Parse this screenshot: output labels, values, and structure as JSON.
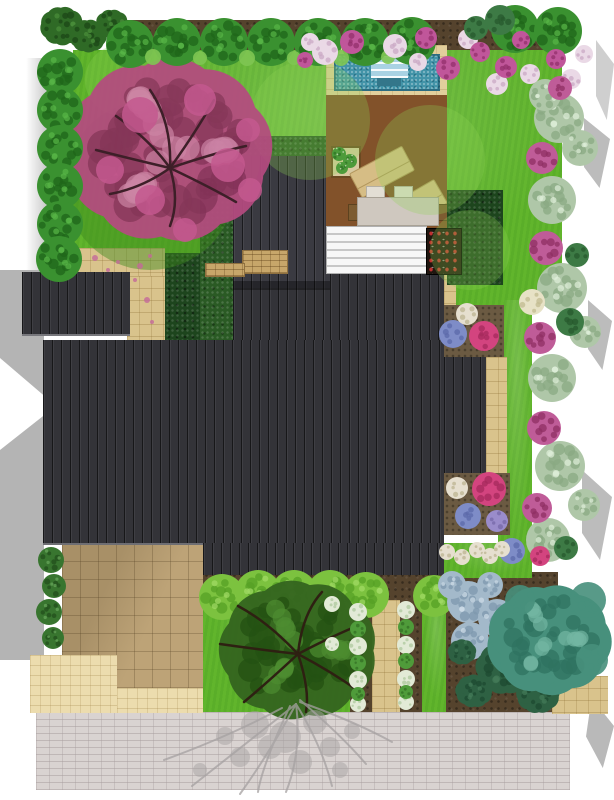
{
  "scene_type": "landscape-garden-design-plan-top-view",
  "palette": {
    "lawn": "#61b52c",
    "roof": "#333338",
    "deck_wood": "#82522a",
    "pool_water": "#4293a8",
    "pool_steps": "#a9d2e3",
    "hedge_dark": "#1d451d",
    "patio_tan": "#bda377",
    "path_beige": "#d9c38c",
    "driveway_gray": "#d9d3d1",
    "soil": "#55432d",
    "pink_tree": "#b54b80",
    "border_pink": "#bf5c98",
    "border_silver": "#afc7a8",
    "teal_tree": "#47907c",
    "shadow_gray": "#bcbcbc"
  },
  "plants": {
    "groups": [
      {
        "name": "lawn-shade-under-tree",
        "type": "blob",
        "fill": "#3f8b1e",
        "op": 0.45,
        "items": [
          [
            150,
            185,
            85
          ],
          [
            210,
            160,
            50
          ]
        ]
      },
      {
        "name": "lawn-light-patches",
        "type": "blob",
        "fill": "#8fd455",
        "op": 0.28,
        "items": [
          [
            310,
            120,
            60
          ],
          [
            430,
            160,
            55
          ],
          [
            120,
            80,
            35
          ],
          [
            470,
            250,
            40
          ]
        ]
      },
      {
        "name": "pink-flowering-tree-canopy",
        "type": "canopy",
        "fill": "#b54b80",
        "spot": "#8a2f5c",
        "hi": "#d683ae",
        "op": 0.93,
        "items": [
          [
            168,
            150,
            95
          ]
        ]
      },
      {
        "name": "pink-tree-branches",
        "type": "branches",
        "stroke": "#3d1f28",
        "width": 2.5,
        "paths": [
          "M170 168 Q150 140 116 116",
          "M170 168 Q172 122 150 90",
          "M170 168 Q196 132 214 100",
          "M170 168 Q218 152 246 146",
          "M170 168 Q212 188 236 202",
          "M170 168 Q142 188 110 194",
          "M170 168 Q136 160 96 150",
          "M170 168 Q180 200 170 226"
        ]
      },
      {
        "name": "pink-tree-outer-blossoms",
        "type": "blob",
        "fill": "#c4598f",
        "op": 0.85,
        "items": [
          [
            140,
            115,
            18
          ],
          [
            200,
            100,
            16
          ],
          [
            228,
            165,
            17
          ],
          [
            150,
            200,
            15
          ],
          [
            110,
            170,
            14
          ],
          [
            250,
            190,
            12
          ],
          [
            185,
            230,
            12
          ],
          [
            248,
            130,
            12
          ]
        ]
      },
      {
        "name": "top-corner-bamboo",
        "type": "canopy",
        "fill": "#2f6a26",
        "spot": "#1c4717",
        "hi": "#4a8f3a",
        "items": [
          [
            62,
            26,
            20
          ],
          [
            88,
            36,
            17
          ],
          [
            112,
            24,
            15
          ],
          [
            135,
            40,
            14
          ]
        ]
      },
      {
        "name": "top-border-shrubs",
        "type": "shrub",
        "r": 24,
        "fill": "#3a9130",
        "spot": "#1f661a",
        "hi": "#58b647",
        "items": [
          [
            130,
            44
          ],
          [
            177,
            42
          ],
          [
            224,
            42
          ],
          [
            271,
            42
          ],
          [
            318,
            42
          ],
          [
            365,
            42
          ],
          [
            412,
            41
          ],
          [
            515,
            29
          ],
          [
            558,
            31
          ]
        ]
      },
      {
        "name": "left-border-shrubs",
        "type": "shrub",
        "r": 23,
        "fill": "#3a9130",
        "spot": "#1f661a",
        "hi": "#58b647",
        "items": [
          [
            60,
            72
          ],
          [
            60,
            110
          ],
          [
            60,
            148
          ],
          [
            60,
            186
          ],
          [
            60,
            224
          ],
          [
            59,
            259
          ]
        ]
      },
      {
        "name": "top-border-tufts",
        "type": "blob",
        "fill": "#7fc653",
        "op": 0.9,
        "items": [
          [
            153,
            57,
            8
          ],
          [
            200,
            58,
            7
          ],
          [
            247,
            58,
            8
          ],
          [
            294,
            58,
            7
          ],
          [
            341,
            58,
            8
          ],
          [
            388,
            57,
            7
          ]
        ]
      },
      {
        "name": "top-bed-white-flowers",
        "type": "cluster",
        "fill": "#ead9e6",
        "spot": "#c9a8c4",
        "items": [
          [
            325,
            52,
            13
          ],
          [
            395,
            46,
            12
          ],
          [
            468,
            39,
            10
          ],
          [
            497,
            84,
            11
          ],
          [
            530,
            74,
            10
          ],
          [
            418,
            62,
            9
          ],
          [
            571,
            79,
            10
          ],
          [
            584,
            54,
            9
          ],
          [
            310,
            42,
            9
          ]
        ]
      },
      {
        "name": "top-bed-pink-flowers",
        "type": "cluster",
        "fill": "#c0569a",
        "spot": "#93306b",
        "items": [
          [
            352,
            42,
            12
          ],
          [
            426,
            38,
            11
          ],
          [
            448,
            68,
            12
          ],
          [
            480,
            52,
            10
          ],
          [
            506,
            67,
            11
          ],
          [
            521,
            40,
            9
          ],
          [
            556,
            59,
            10
          ],
          [
            305,
            60,
            8
          ]
        ]
      },
      {
        "name": "right-border-silver-foliage",
        "type": "blob",
        "fill": "#afc7a8",
        "spot": "#8aa983",
        "hi": "#dff0da",
        "items": [
          [
            559,
            118,
            25
          ],
          [
            552,
            200,
            24
          ],
          [
            562,
            288,
            25
          ],
          [
            552,
            378,
            24
          ],
          [
            560,
            466,
            25
          ],
          [
            548,
            540,
            22
          ],
          [
            580,
            148,
            18
          ],
          [
            585,
            332,
            16
          ],
          [
            584,
            505,
            16
          ],
          [
            545,
            95,
            16
          ]
        ]
      },
      {
        "name": "right-border-pink-clusters",
        "type": "cluster",
        "fill": "#bf5c98",
        "spot": "#8f2f63",
        "items": [
          [
            542,
            158,
            16
          ],
          [
            546,
            248,
            17
          ],
          [
            540,
            338,
            16
          ],
          [
            544,
            428,
            17
          ],
          [
            537,
            508,
            15
          ],
          [
            560,
            88,
            12
          ]
        ]
      },
      {
        "name": "right-border-cream-cluster",
        "type": "cluster",
        "fill": "#e7e2c6",
        "spot": "#c2bb90",
        "items": [
          [
            532,
            302,
            13
          ]
        ]
      },
      {
        "name": "right-border-dark-shrubs",
        "type": "blob",
        "fill": "#3d7a45",
        "spot": "#275a2e",
        "items": [
          [
            570,
            322,
            14
          ],
          [
            577,
            255,
            12
          ],
          [
            566,
            548,
            12
          ],
          [
            500,
            20,
            15
          ],
          [
            476,
            28,
            12
          ]
        ]
      },
      {
        "name": "deck-planter-plants",
        "type": "blob",
        "fill": "#4d9b3b",
        "spot": "#2f7326",
        "hi": "#dfe8d0",
        "items": [
          [
            339,
            154,
            7
          ],
          [
            350,
            161,
            7
          ],
          [
            342,
            168,
            6
          ]
        ]
      },
      {
        "name": "hydrangea-blue",
        "type": "cluster",
        "fill": "#7e8cc7",
        "spot": "#5c6aaa",
        "items": [
          [
            453,
            334,
            14
          ],
          [
            468,
            516,
            13
          ],
          [
            512,
            551,
            13
          ]
        ]
      },
      {
        "name": "azalea-pink",
        "type": "cluster",
        "fill": "#d3447f",
        "spot": "#a62a5c",
        "items": [
          [
            484,
            336,
            15
          ],
          [
            489,
            489,
            17
          ],
          [
            540,
            556,
            10
          ]
        ]
      },
      {
        "name": "bed-white-flowers",
        "type": "cluster",
        "fill": "#e6dfcf",
        "spot": "#bcb491",
        "items": [
          [
            467,
            314,
            11
          ],
          [
            457,
            488,
            11
          ],
          [
            447,
            552,
            8
          ],
          [
            462,
            557,
            8
          ],
          [
            477,
            550,
            8
          ],
          [
            490,
            556,
            8
          ],
          [
            502,
            549,
            8
          ]
        ]
      },
      {
        "name": "bed-purple-cluster",
        "type": "cluster",
        "fill": "#9a8ccb",
        "spot": "#7668a8",
        "items": [
          [
            497,
            521,
            11
          ]
        ]
      },
      {
        "name": "left-wall-climbers",
        "type": "blob",
        "fill": "#38752f",
        "spot": "#224f1c",
        "hi": "#6aa85c",
        "items": [
          [
            51,
            560,
            13
          ],
          [
            54,
            586,
            12
          ],
          [
            49,
            612,
            13
          ],
          [
            53,
            638,
            11
          ]
        ]
      },
      {
        "name": "front-round-trees",
        "type": "shrub",
        "fill": "#7cc23f",
        "spot": "#55a026",
        "hi": "#a2dc67",
        "items": [
          [
            222,
            597,
            23
          ],
          [
            258,
            593,
            23
          ],
          [
            294,
            593,
            23
          ],
          [
            330,
            593,
            23
          ],
          [
            366,
            595,
            23
          ],
          [
            434,
            596,
            21
          ]
        ]
      },
      {
        "name": "front-dark-tree-canopy",
        "type": "canopy",
        "fill": "#35661f",
        "spot": "#224e12",
        "hi": "#4d8b30",
        "op": 0.96,
        "items": [
          [
            298,
            650,
            72
          ]
        ]
      },
      {
        "name": "front-dark-tree-branches",
        "type": "branches",
        "stroke": "#2e2012",
        "width": 2.5,
        "paths": [
          "M298 654 Q268 622 238 606",
          "M298 654 Q302 614 322 592",
          "M298 654 Q332 636 362 624",
          "M298 654 Q332 672 360 692",
          "M298 654 Q268 682 244 702",
          "M298 654 Q262 650 220 644",
          "M298 654 Q310 690 306 712"
        ]
      },
      {
        "name": "front-white-hostas",
        "type": "cluster",
        "fill": "#e2ead6",
        "spot": "#aec89e",
        "items": [
          [
            358,
            612,
            9
          ],
          [
            406,
            610,
            9
          ],
          [
            358,
            646,
            9
          ],
          [
            406,
            645,
            9
          ],
          [
            358,
            680,
            9
          ],
          [
            406,
            679,
            9
          ],
          [
            358,
            704,
            8
          ],
          [
            406,
            702,
            8
          ],
          [
            332,
            604,
            8
          ],
          [
            332,
            644,
            7
          ]
        ]
      },
      {
        "name": "front-green-balls",
        "type": "blob",
        "fill": "#4f9b3a",
        "spot": "#336f24",
        "items": [
          [
            358,
            629,
            8
          ],
          [
            406,
            627,
            8
          ],
          [
            358,
            663,
            8
          ],
          [
            406,
            661,
            8
          ],
          [
            358,
            694,
            7
          ],
          [
            406,
            692,
            7
          ]
        ]
      },
      {
        "name": "blue-gray-hostas",
        "type": "blob",
        "fill": "#a3b9ca",
        "spot": "#7e98ad",
        "hi": "#cfdde8",
        "items": [
          [
            468,
            602,
            21
          ],
          [
            497,
            618,
            19
          ],
          [
            470,
            641,
            19
          ],
          [
            452,
            585,
            14
          ],
          [
            490,
            585,
            13
          ]
        ]
      },
      {
        "name": "conifer-shrubs",
        "type": "canopy",
        "fill": "#2e6143",
        "spot": "#1d4a30",
        "hi": "#447a58",
        "items": [
          [
            505,
            668,
            27
          ],
          [
            538,
            694,
            20
          ],
          [
            474,
            691,
            17
          ],
          [
            462,
            652,
            13
          ]
        ]
      },
      {
        "name": "teal-specimen-tree",
        "type": "canopy",
        "fill": "#47907c",
        "spot": "#2f7360",
        "hi": "#74b7a2",
        "items": [
          [
            549,
            640,
            57
          ]
        ]
      },
      {
        "name": "teal-tree-outer",
        "type": "blob",
        "fill": "#47907c",
        "op": 0.9,
        "items": [
          [
            588,
            600,
            18
          ],
          [
            592,
            660,
            16
          ],
          [
            520,
            600,
            15
          ]
        ]
      },
      {
        "name": "driveway-tree-shadow-branches",
        "type": "branches",
        "stroke": "#a5a1a1",
        "width": 2,
        "op": 0.75,
        "paths": [
          "M296 704 Q248 742 192 786",
          "M296 704 Q270 752 240 794",
          "M296 704 Q302 752 286 792",
          "M296 704 Q322 746 332 786",
          "M300 700 Q342 736 366 764",
          "M282 708 Q230 736 164 760",
          "M300 702 Q356 722 392 742",
          "M290 706 Q262 766 258 792"
        ]
      },
      {
        "name": "driveway-tree-shadow-leaves",
        "type": "blob",
        "fill": "#a8a4a4",
        "op": 0.5,
        "items": [
          [
            255,
            725,
            14
          ],
          [
            285,
            737,
            16
          ],
          [
            315,
            722,
            12
          ],
          [
            240,
            757,
            10
          ],
          [
            300,
            762,
            12
          ],
          [
            270,
            747,
            12
          ],
          [
            330,
            747,
            10
          ],
          [
            352,
            731,
            8
          ],
          [
            225,
            736,
            9
          ],
          [
            200,
            770,
            7
          ],
          [
            340,
            770,
            8
          ]
        ]
      },
      {
        "name": "fallen-petals-on-path",
        "type": "dot",
        "fill": "#c46a9a",
        "op": 0.8,
        "items": [
          [
            95,
            258,
            3
          ],
          [
            118,
            262,
            2
          ],
          [
            140,
            266,
            3
          ],
          [
            108,
            270,
            2
          ],
          [
            150,
            256,
            2
          ],
          [
            135,
            280,
            2
          ],
          [
            147,
            300,
            3
          ],
          [
            152,
            322,
            2
          ]
        ]
      }
    ]
  }
}
